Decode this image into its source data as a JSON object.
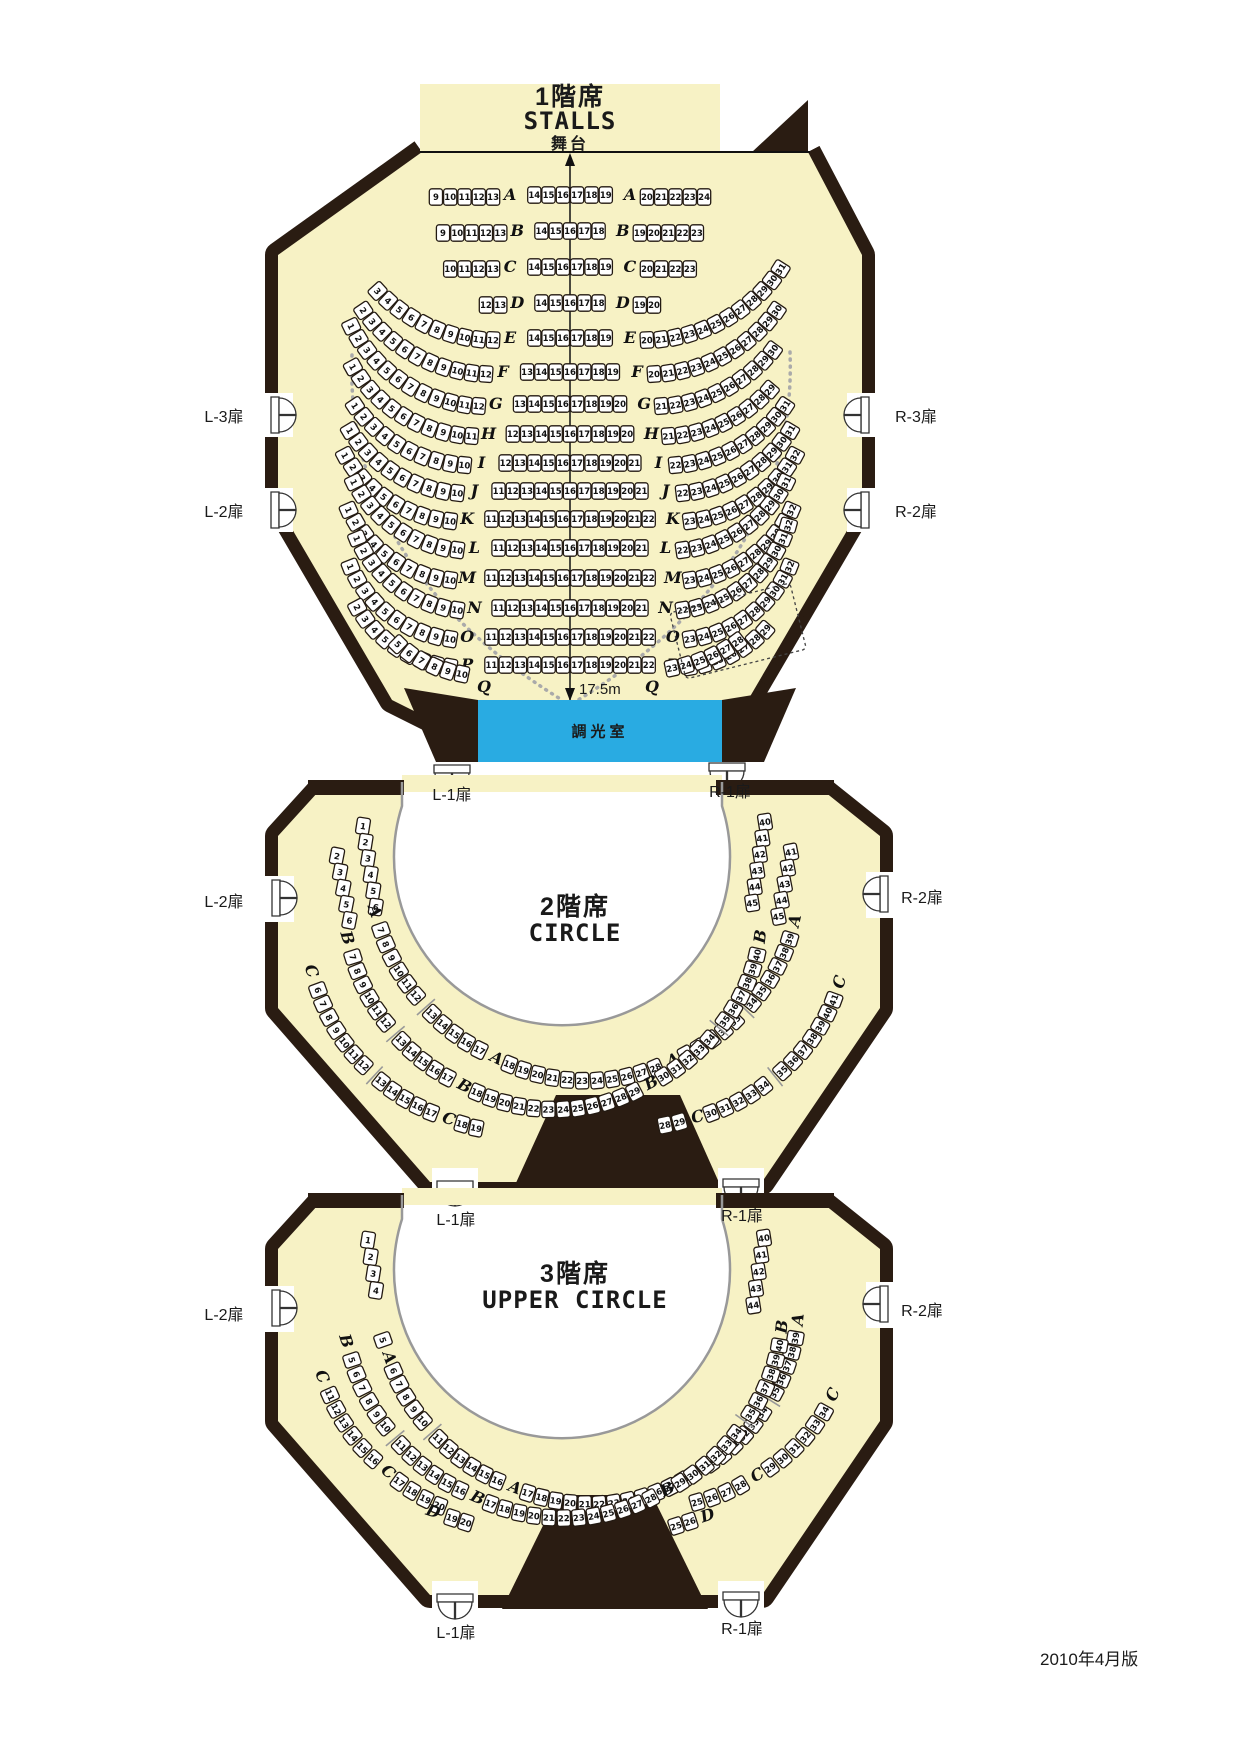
{
  "theme": {
    "wall": "#2a1c12",
    "floor": "#f7f2c5",
    "seat_fill": "#ffffff",
    "seat_stroke": "#231a12",
    "ink": "#111111",
    "gray": "#999999",
    "cyan": "#29abe2"
  },
  "caption": "2010年4月版",
  "stalls": {
    "title_jp": "1階席",
    "title_en": "STALLS",
    "stage_label": "舞台",
    "dimension": "17.5m",
    "lightroom": "調光室",
    "doors": {
      "l3": "L-3扉",
      "l2": "L-2扉",
      "l1": "L-1扉",
      "r3": "R-3扉",
      "r2": "R-2扉",
      "r1": "R-1扉"
    },
    "rows": [
      {
        "letter": "A",
        "left": [
          9,
          13
        ],
        "center": [
          14,
          19
        ],
        "right": [
          20,
          24
        ]
      },
      {
        "letter": "B",
        "left": [
          9,
          13
        ],
        "center": [
          14,
          18
        ],
        "right": [
          19,
          23
        ]
      },
      {
        "letter": "C",
        "left": [
          10,
          13
        ],
        "center": [
          14,
          19
        ],
        "right": [
          20,
          23
        ]
      },
      {
        "letter": "D",
        "left": [
          12,
          13
        ],
        "center": [
          14,
          18
        ],
        "right": [
          19,
          20
        ]
      },
      {
        "letter": "E",
        "left": [
          3,
          12
        ],
        "center": [
          14,
          19
        ],
        "right": [
          20,
          31
        ]
      },
      {
        "letter": "F",
        "left": [
          2,
          12
        ],
        "center": [
          13,
          19
        ],
        "right": [
          20,
          30
        ]
      },
      {
        "letter": "G",
        "left": [
          1,
          12
        ],
        "center": [
          13,
          20
        ],
        "right": [
          21,
          30
        ]
      },
      {
        "letter": "H",
        "left": [
          1,
          11
        ],
        "center": [
          12,
          20
        ],
        "right": [
          21,
          29
        ]
      },
      {
        "letter": "I",
        "left": [
          1,
          10
        ],
        "center": [
          12,
          21
        ],
        "right": [
          22,
          31
        ]
      },
      {
        "letter": "J",
        "left": [
          1,
          10
        ],
        "center": [
          11,
          21
        ],
        "right": [
          22,
          31
        ]
      },
      {
        "letter": "K",
        "left": [
          1,
          10
        ],
        "center": [
          11,
          22
        ],
        "right": [
          23,
          32
        ]
      },
      {
        "letter": "L",
        "left": [
          1,
          10
        ],
        "center": [
          11,
          21
        ],
        "right": [
          22,
          31
        ]
      },
      {
        "letter": "M",
        "left": [
          1,
          10
        ],
        "center": [
          11,
          22
        ],
        "right": [
          23,
          32
        ]
      },
      {
        "letter": "N",
        "left": [
          1,
          10
        ],
        "center": [
          11,
          21
        ],
        "right": [
          22,
          32
        ]
      },
      {
        "letter": "O",
        "left": [
          1,
          10
        ],
        "center": [
          11,
          22
        ],
        "right": [
          23,
          32
        ]
      },
      {
        "letter": "P",
        "left": [
          2,
          10
        ],
        "center": [
          11,
          22
        ],
        "right": [
          23,
          29
        ]
      },
      {
        "letter": "Q",
        "left": [
          5,
          10
        ],
        "center": null,
        "right": [
          23,
          28
        ]
      }
    ]
  },
  "circle": {
    "title_jp": "2階席",
    "title_en": "CIRCLE",
    "doors": {
      "l2": "L-2扉",
      "l1": "L-1扉",
      "r2": "R-2扉",
      "r1": "R-1扉"
    },
    "rows": [
      {
        "letter": "A",
        "segments": [
          [
            1,
            6
          ],
          [
            7,
            39
          ],
          [
            40,
            45
          ]
        ]
      },
      {
        "letter": "B",
        "segments": [
          [
            2,
            6
          ],
          [
            7,
            40
          ],
          [
            41,
            45
          ]
        ]
      },
      {
        "letter": "C",
        "segments": [
          [
            6,
            19
          ],
          [
            28,
            41
          ]
        ]
      }
    ]
  },
  "upper_circle": {
    "title_jp": "3階席",
    "title_en": "UPPER CIRCLE",
    "doors": {
      "l2": "L-2扉",
      "l1": "L-1扉",
      "r2": "R-2扉",
      "r1": "R-1扉"
    },
    "rows": [
      {
        "letter": "A",
        "segments": [
          [
            1,
            4
          ],
          [
            5,
            39
          ],
          [
            40,
            44
          ]
        ]
      },
      {
        "letter": "B",
        "segments": [
          [
            5,
            40
          ]
        ]
      },
      {
        "letter": "C",
        "segments": [
          [
            11,
            20
          ],
          [
            25,
            34
          ]
        ]
      },
      {
        "letter": "D",
        "segments": [
          [
            19,
            20
          ],
          [
            25,
            26
          ]
        ]
      }
    ]
  }
}
